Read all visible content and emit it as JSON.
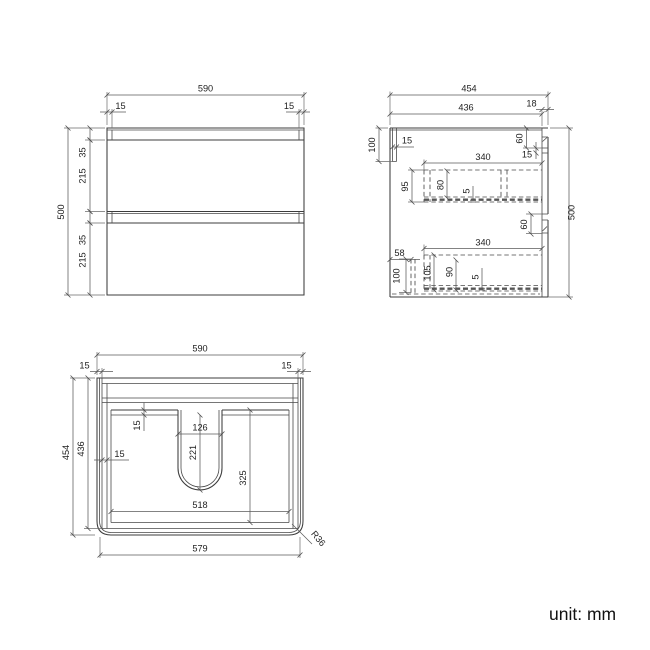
{
  "footer": {
    "unit_label": "unit: mm"
  },
  "views": {
    "front": {
      "dims": {
        "overall_width": "590",
        "top_reveal_left": "15",
        "top_reveal_right": "15",
        "overall_height": "500",
        "top_gap": "35",
        "drawer_front_upper": "215",
        "middle_gap": "35",
        "drawer_front_lower": "215"
      }
    },
    "side": {
      "dims": {
        "overall_depth": "454",
        "carcass_depth": "436",
        "front_panel": "18",
        "hang_rail_height": "100",
        "hang_rail_thickness": "15",
        "top_recess": "60",
        "top_lip": "15",
        "drawer_box_upper_length": "340",
        "drawer_box_upper_height": "95",
        "drawer_box_upper_inner": "80",
        "drawer_box_upper_bottom": "5",
        "middle_recess": "60",
        "drawer_box_lower_length": "340",
        "bottom_rail_offset": "58",
        "bottom_rail_height": "100",
        "drawer_box_lower_height": "105",
        "drawer_box_lower_inner": "90",
        "drawer_box_lower_bottom": "5",
        "overall_height": "500"
      }
    },
    "plan": {
      "dims": {
        "overall_width": "590",
        "panel_left": "15",
        "panel_right": "15",
        "overall_depth": "454",
        "carcass_depth": "436",
        "back_lip": "15",
        "cutout_width": "126",
        "cutout_depth": "221",
        "side_wall": "15",
        "inner_depth": "325",
        "inner_width": "518",
        "front_width": "579",
        "corner_radius": "R36"
      }
    }
  }
}
